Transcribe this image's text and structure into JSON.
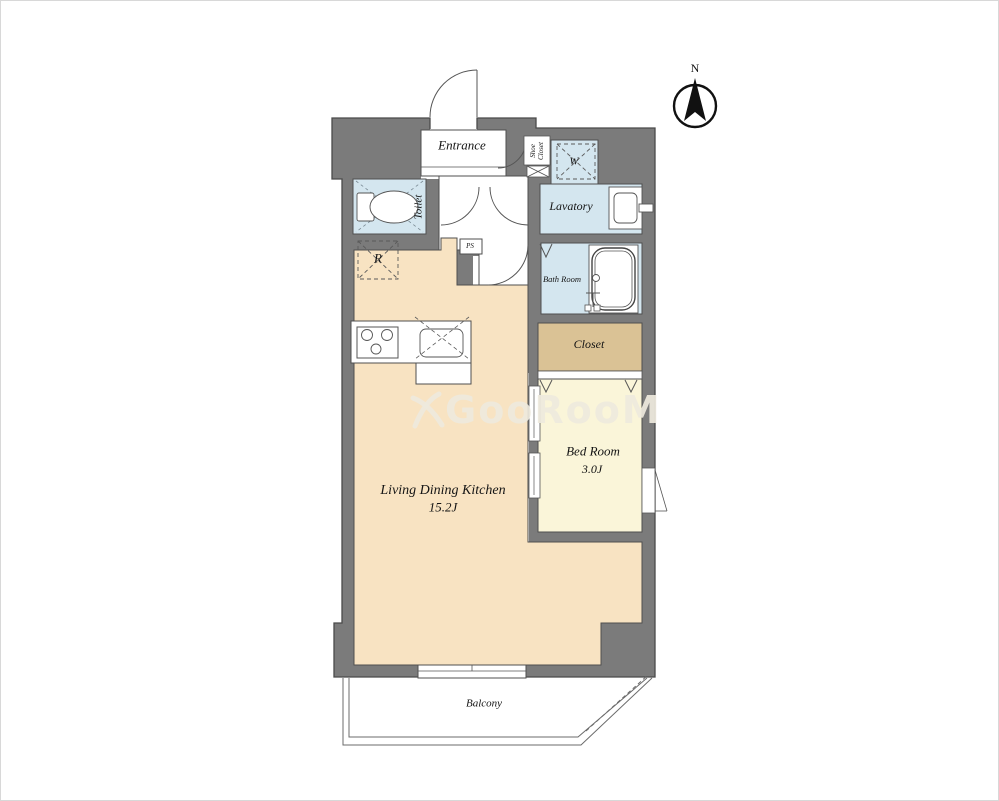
{
  "meta": {
    "type": "apartment-floor-plan",
    "orientation_mark": "N"
  },
  "colors": {
    "wall": "#7b7b7b",
    "outline": "#4a4a4a",
    "floor_ldk": "#f8e3c2",
    "floor_bedroom": "#faf5d9",
    "floor_wet_area": "#d4e6ef",
    "floor_closet": "#dac295",
    "floor_white": "#ffffff",
    "watermark": "#eee9dd"
  },
  "compass": {
    "label": "N"
  },
  "rooms": {
    "entrance": {
      "label": "Entrance"
    },
    "shoe_closet": {
      "label": "Shoe\nCloset"
    },
    "washer": {
      "label": "W"
    },
    "toilet": {
      "label": "Toilet"
    },
    "lavatory": {
      "label": "Lavatory"
    },
    "bath": {
      "label": "Bath Room"
    },
    "ps": {
      "label": "PS"
    },
    "fridge": {
      "label": "R"
    },
    "closet": {
      "label": "Closet"
    },
    "bedroom": {
      "label": "Bed Room",
      "size": "3.0J"
    },
    "ldk": {
      "label": "Living Dining Kitchen",
      "size": "15.2J"
    },
    "balcony": {
      "label": "Balcony"
    }
  },
  "watermark": {
    "text": "GooRooM"
  }
}
